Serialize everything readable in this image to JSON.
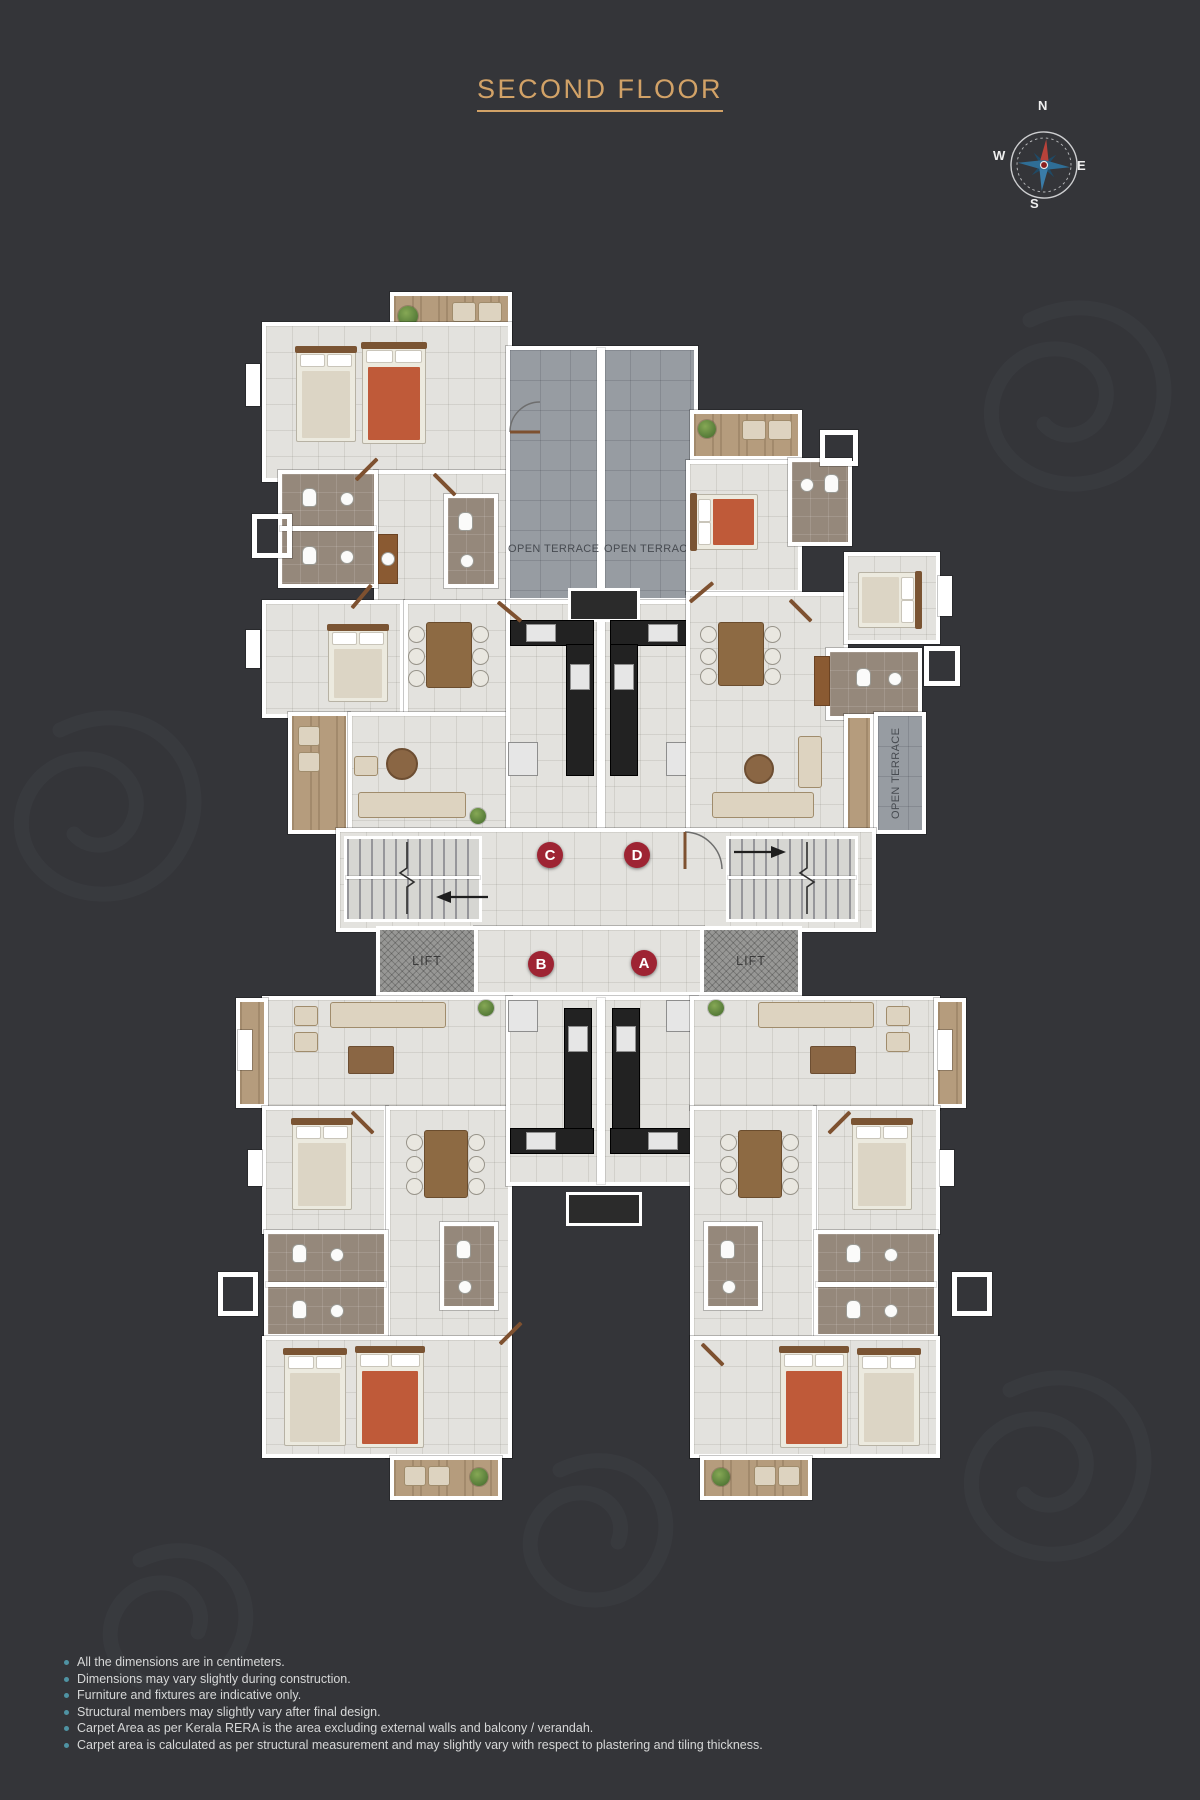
{
  "title": {
    "text": "SECOND FLOOR"
  },
  "compass": {
    "north": "N",
    "east": "E",
    "south": "S",
    "west": "W"
  },
  "plan": {
    "terraces": {
      "upper_left_label": "OPEN TERRACE",
      "upper_right_label": "OPEN TERRACE",
      "side_label": "OPEN TERRACE"
    },
    "units": [
      {
        "id": "C"
      },
      {
        "id": "D"
      },
      {
        "id": "B"
      },
      {
        "id": "A"
      }
    ],
    "lifts": [
      {
        "label": "LIFT"
      },
      {
        "label": "LIFT"
      }
    ]
  },
  "colors": {
    "background": "#343539",
    "accent_gold": "#d2a267",
    "badge_red": "#9e2433",
    "bullet_teal": "#4f93a3",
    "terrace_gray": "#979ca2",
    "floor_light": "#e3e2de"
  },
  "disclaimers": {
    "items": [
      "All the dimensions are in centimeters.",
      "Dimensions may vary slightly during construction.",
      "Furniture and fixtures are indicative only.",
      "Structural members may slightly vary after final design.",
      "Carpet Area as per Kerala RERA is the area excluding external walls and balcony / verandah.",
      "Carpet area is calculated as per structural measurement and may slightly vary with respect to plastering and tiling thickness."
    ]
  }
}
